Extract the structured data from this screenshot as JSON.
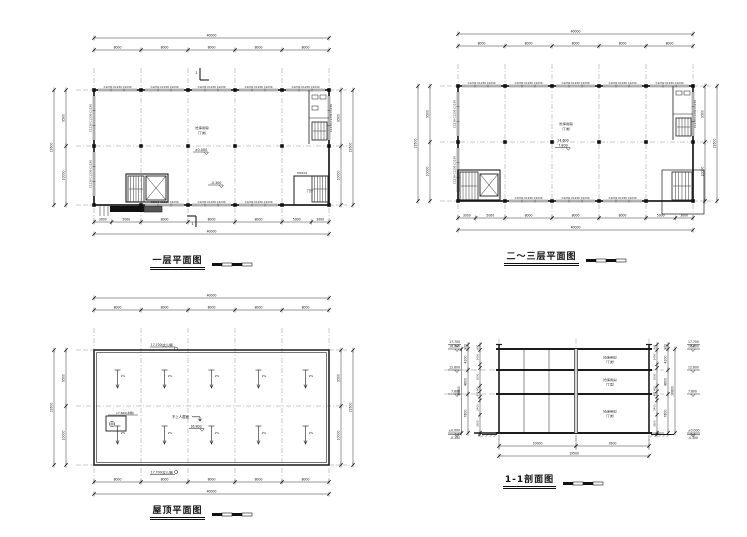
{
  "sheet": {
    "bg": "#ffffff"
  },
  "drawing": {
    "line": "#1b1b1b",
    "dim": "#2a2a2a",
    "text": "#111111",
    "grid": "#777777",
    "fill": "#111111"
  },
  "plan": {
    "total_width": "40000",
    "bays": [
      "8000",
      "8000",
      "8000",
      "8000",
      "8000"
    ],
    "bottom_segs": [
      "3000",
      "5000",
      "8000",
      "8000",
      "8000",
      "5000",
      "3000"
    ],
    "bottom_total": "40000",
    "side_segs": [
      "9500",
      "10000"
    ],
    "side_total": "19500",
    "window_tag": "C1230",
    "window_group": "C1230 C1230 C1230"
  },
  "floor1": {
    "title": "一层平面图",
    "room_line1": "（仓库用房）",
    "room_line2": "（丁类）",
    "level_main": "±0.000",
    "level_entry": "-0.300",
    "door_tag": "M1524",
    "hall": "门厅",
    "section_mark": "1"
  },
  "floor23": {
    "title": "二～三层平面图",
    "room_line1": "（仓库用房）",
    "room_line2": "（丁类）",
    "level_line1": "14.600",
    "level_line2": "7.800"
  },
  "roof": {
    "title": "屋顶平面图",
    "parapet_label": "17.700(女儿墙)",
    "surface_level": "16.800",
    "note": "不上人屋面",
    "slope_label": "2%",
    "tank_label": "17.600(水箱)",
    "bottom_segs": [
      "8000",
      "8000",
      "8000",
      "8000",
      "8000"
    ],
    "bottom_total": "40000"
  },
  "section": {
    "title": "1-1剖面图",
    "room_line1": "（仓库用房）",
    "room_line2": "（丁类）",
    "levels_text": [
      "17.700",
      "16.800",
      "12.600",
      "7.800",
      "±0.000",
      "-0.300"
    ],
    "outer_dims": [
      "900",
      "4200",
      "4800",
      "7800"
    ],
    "outer_total": "16800",
    "inner_dims": [
      "900",
      "2400",
      "600",
      "3000",
      "900",
      "900",
      "600",
      "2400",
      "3000",
      "300"
    ],
    "bottom_segs": [
      "10000",
      "9500"
    ],
    "bottom_total": "19500"
  }
}
